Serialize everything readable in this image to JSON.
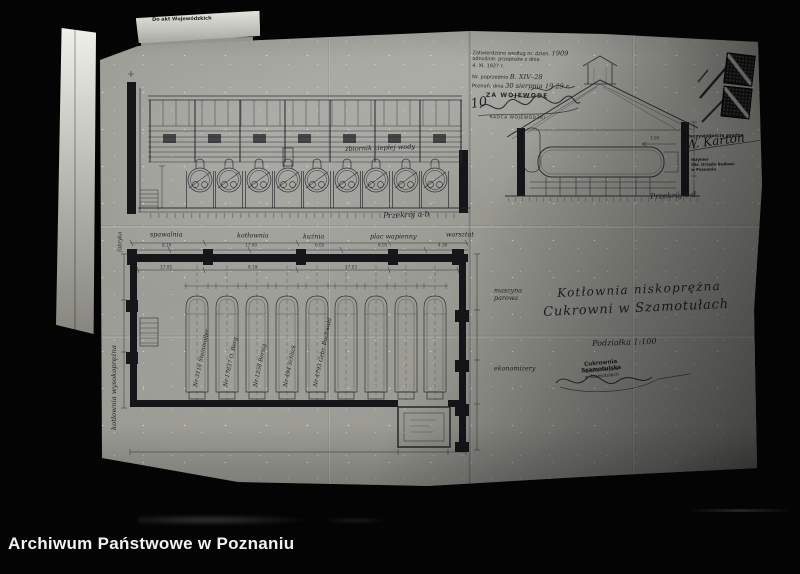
{
  "archive": {
    "caption": "Archiwum Państwowe w Poznaniu"
  },
  "colors": {
    "background": "#040404",
    "paper": "#96968f",
    "ink": "#22222a",
    "caption_text": "#f2f2f2"
  },
  "note_tab": {
    "label": "Do akt Wojewódzkich"
  },
  "approval_stamp": {
    "line1": "Zatwierdzono według nr. dzien.",
    "line1_hw": "1909",
    "line2": "odnośnie: przepisów z dnia",
    "line3": "4. XI. 1927 r.",
    "line4": "Nr. poprzednio",
    "line4_hw": "B. XIV–28",
    "line5": "Poznań, dnia",
    "line5_hw": "30 sierpnia 19 29 r.",
    "za_wojewode": "ZA WOJEWODĘ",
    "official_title": "RADCA WOJEWÓDZKI",
    "number_note": "10"
  },
  "certification": {
    "line": "Z rzeczywistością zgodne",
    "signature": "W. Karton",
    "stamp_lines": [
      "Inżynier",
      "Okr. Urzędu Budowl.",
      "w Poznaniu"
    ]
  },
  "drawing": {
    "title_line1": "Kotłownia niskoprężna",
    "title_line2": "Cukrowni w Szamotułach",
    "scale": "Podziałka 1:100",
    "section_ab": "Przekrój a-b",
    "section_cd": "Przekrój c-d",
    "elevation_note": "zbiornik ciepłej wody",
    "dim_360": "3.60"
  },
  "plan": {
    "room_labels": [
      "spawalnia",
      "kotłownia",
      "kuźnia",
      "plac wapienny",
      "warsztat"
    ],
    "edge_label": "fabryka",
    "left_label": "kotłownia wysokoprężna",
    "right_labels": [
      "maszyna parowa",
      "ekonomizery"
    ],
    "boiler_numbers": [
      "Nr 3116 Steinmüller",
      "Nr 17837 O. Berg",
      "Nr 1258 Borsig",
      "Nr 494 Schlick",
      "Nr 4793 Gebr. Buchwald"
    ],
    "dims_top": [
      "8.10",
      "17.00",
      "6.05",
      "8.05",
      "4.30"
    ],
    "dims_inner": [
      "17.05",
      "8.10",
      "17.03"
    ]
  },
  "factory_stamp": {
    "line1": "Cukrownia Szamotulska",
    "line2": "Spółka Akcyjna",
    "line3": "w Szamotułach"
  }
}
